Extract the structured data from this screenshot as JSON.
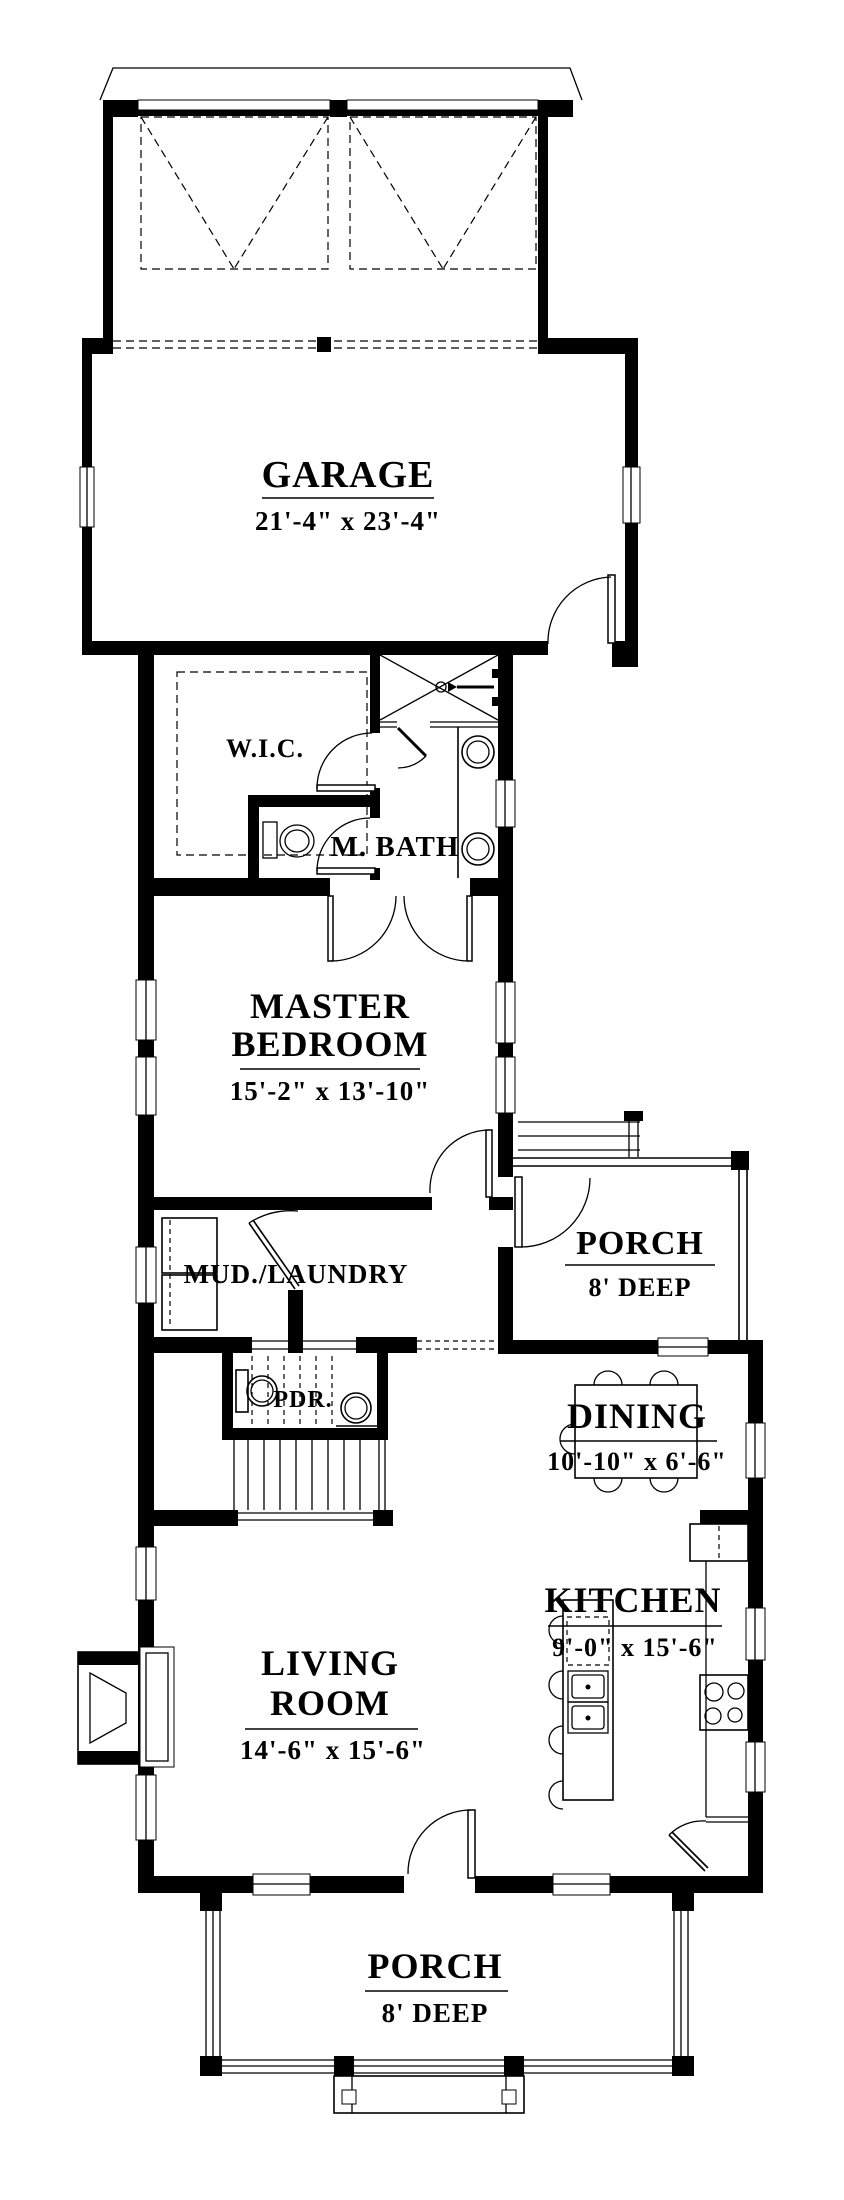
{
  "plan": {
    "colors": {
      "line": "#000000",
      "background": "#ffffff"
    },
    "rooms": {
      "garage": {
        "label": "GARAGE",
        "dims": "21'-4\" x 23'-4\""
      },
      "wic": {
        "label": "W.I.C."
      },
      "master_bath": {
        "label": "M. BATH"
      },
      "master_bedroom": {
        "label_line1": "MASTER",
        "label_line2": "BEDROOM",
        "dims": "15'-2\" x 13'-10\""
      },
      "mud_laundry": {
        "label": "MUD./LAUNDRY"
      },
      "side_porch": {
        "label": "PORCH",
        "dims": "8' DEEP"
      },
      "powder_room": {
        "label": "PDR."
      },
      "dining": {
        "label": "DINING",
        "dims": "10'-10\" x 6'-6\""
      },
      "kitchen": {
        "label": "KITCHEN",
        "dims": "9'-0\" x 15'-6\""
      },
      "living_room": {
        "label_line1": "LIVING",
        "label_line2": "ROOM",
        "dims": "14'-6\" x 15'-6\""
      },
      "front_porch": {
        "label": "PORCH",
        "dims": "8' DEEP"
      }
    }
  }
}
